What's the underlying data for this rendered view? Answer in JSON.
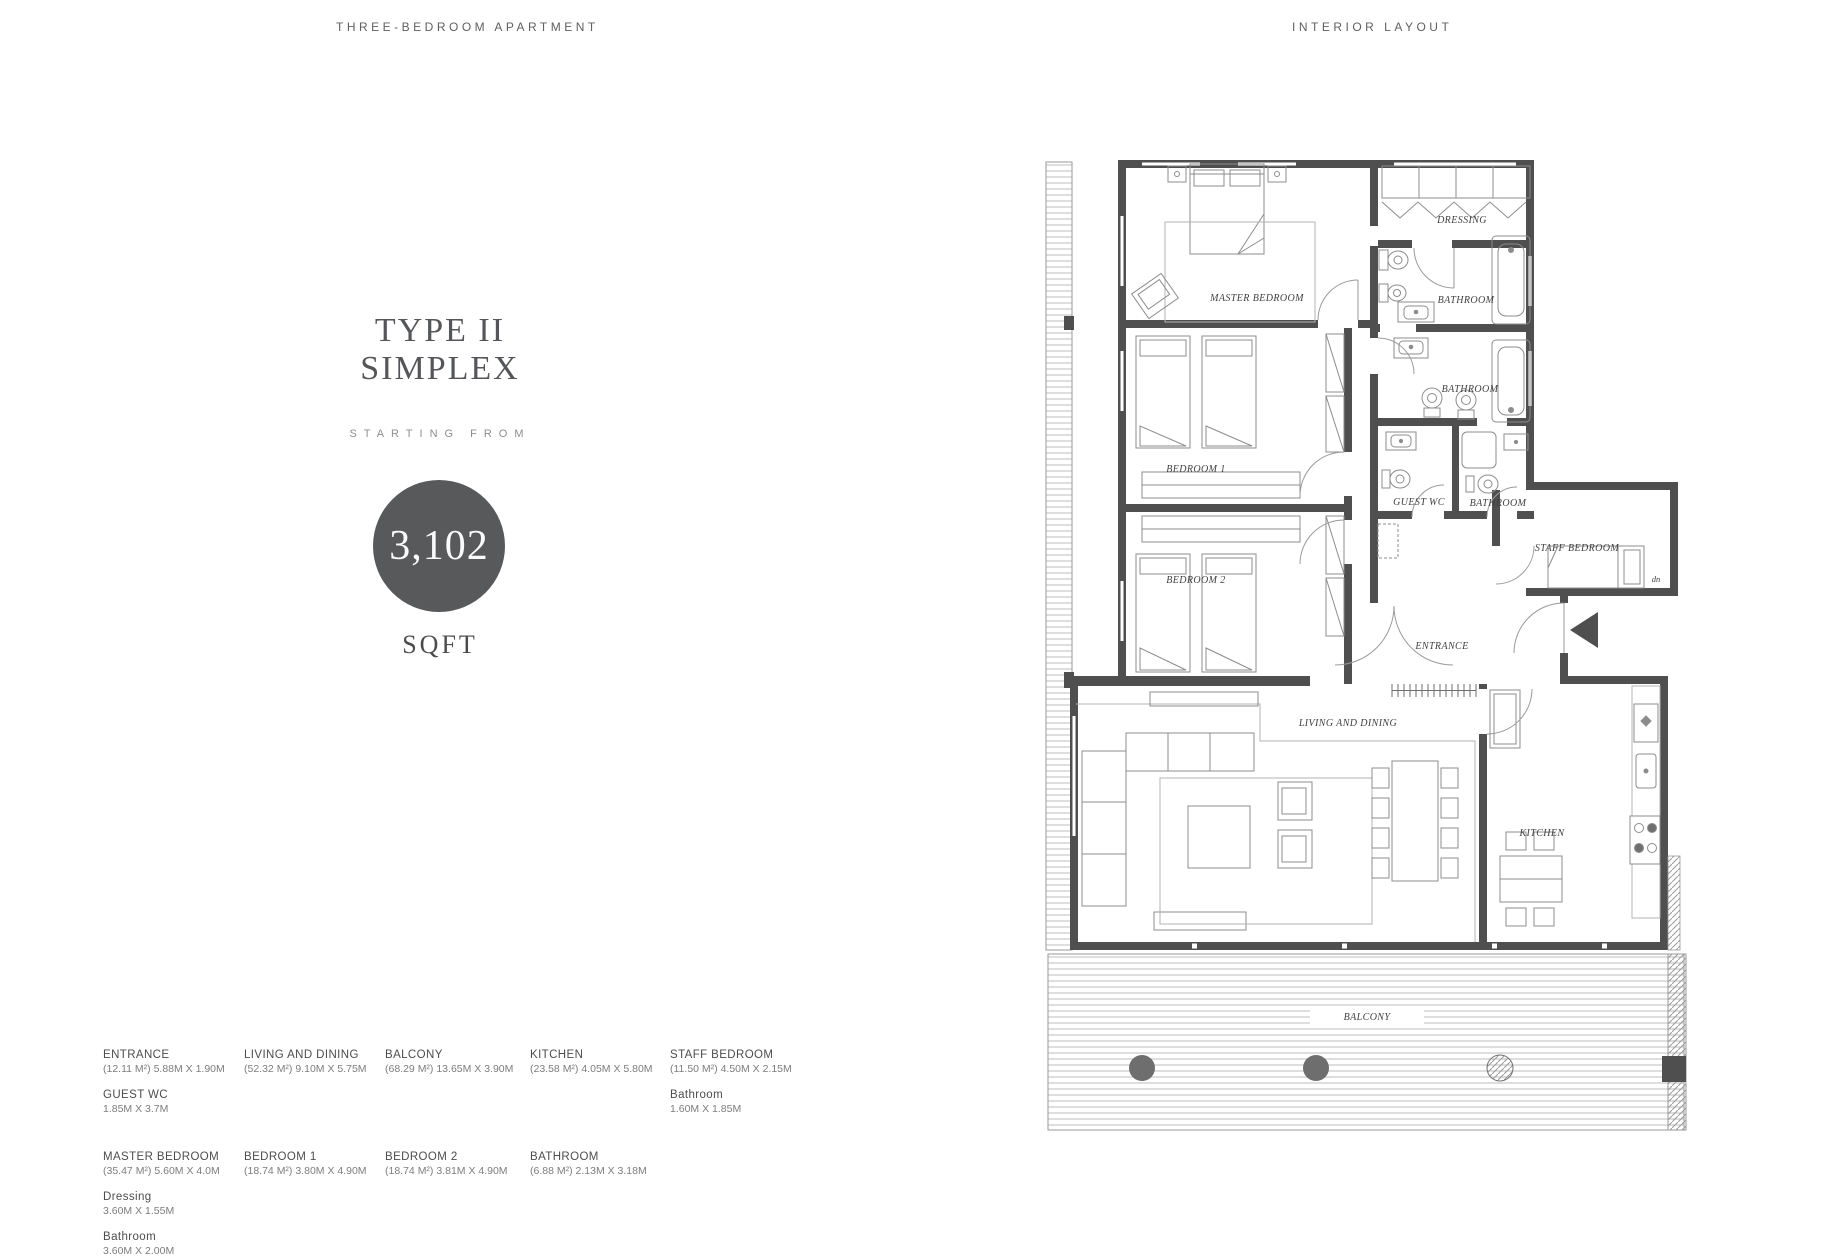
{
  "header": {
    "left_title": "THREE-BEDROOM APARTMENT",
    "right_title": "INTERIOR LAYOUT"
  },
  "summary": {
    "type_line1": "TYPE II",
    "type_line2": "SIMPLEX",
    "starting_from_label": "STARTING FROM",
    "area_value": "3,102",
    "area_unit_label": "SQFT"
  },
  "plan": {
    "labels": {
      "master_bedroom": "MASTER BEDROOM",
      "dressing": "DRESSING",
      "master_bathroom": "BATHROOM",
      "bathroom_2": "BATHROOM",
      "bedroom_1": "BEDROOM 1",
      "bedroom_2": "BEDROOM 2",
      "guest_wc": "GUEST WC",
      "bathroom_3": "BATHROOM",
      "staff_bedroom": "STAFF BEDROOM",
      "entrance": "ENTRANCE",
      "living_dining": "LIVING AND DINING",
      "kitchen": "KITCHEN",
      "balcony": "BALCONY",
      "stairs_note": "dn"
    }
  },
  "dimensions": {
    "row1": [
      {
        "name": "ENTRANCE",
        "size": "(12.11 M²) 5.88M X 1.90M",
        "extras": [
          {
            "name": "GUEST WC",
            "size": "1.85M X 3.7M"
          }
        ]
      },
      {
        "name": "LIVING AND DINING",
        "size": "(52.32 M²) 9.10M X 5.75M",
        "extras": []
      },
      {
        "name": "BALCONY",
        "size": "(68.29 M²) 13.65M X 3.90M",
        "extras": []
      },
      {
        "name": "KITCHEN",
        "size": "(23.58 M²) 4.05M X 5.80M",
        "extras": []
      },
      {
        "name": "STAFF BEDROOM",
        "size": "(11.50 M²) 4.50M X 2.15M",
        "extras": [
          {
            "name": "Bathroom",
            "size": "1.60M X 1.85M"
          }
        ]
      }
    ],
    "row2": [
      {
        "name": "MASTER BEDROOM",
        "size": "(35.47 M²) 5.60M X 4.0M",
        "extras": [
          {
            "name": "Dressing",
            "size": "3.60M X 1.55M"
          },
          {
            "name": "Bathroom",
            "size": "3.60M X 2.00M"
          }
        ]
      },
      {
        "name": "BEDROOM 1",
        "size": "(18.74 M²) 3.80M X 4.90M",
        "extras": []
      },
      {
        "name": "BEDROOM 2",
        "size": "(18.74 M²) 3.81M X 4.90M",
        "extras": []
      },
      {
        "name": "BATHROOM",
        "size": "(6.88 M²) 2.13M X 3.18M",
        "extras": []
      }
    ]
  },
  "colors": {
    "wall": "#4f4f4f",
    "accent_circle": "#58595b",
    "title_text": "#55565a",
    "body_text": "#7d7d7d",
    "plan_line": "#8c8c8c"
  }
}
